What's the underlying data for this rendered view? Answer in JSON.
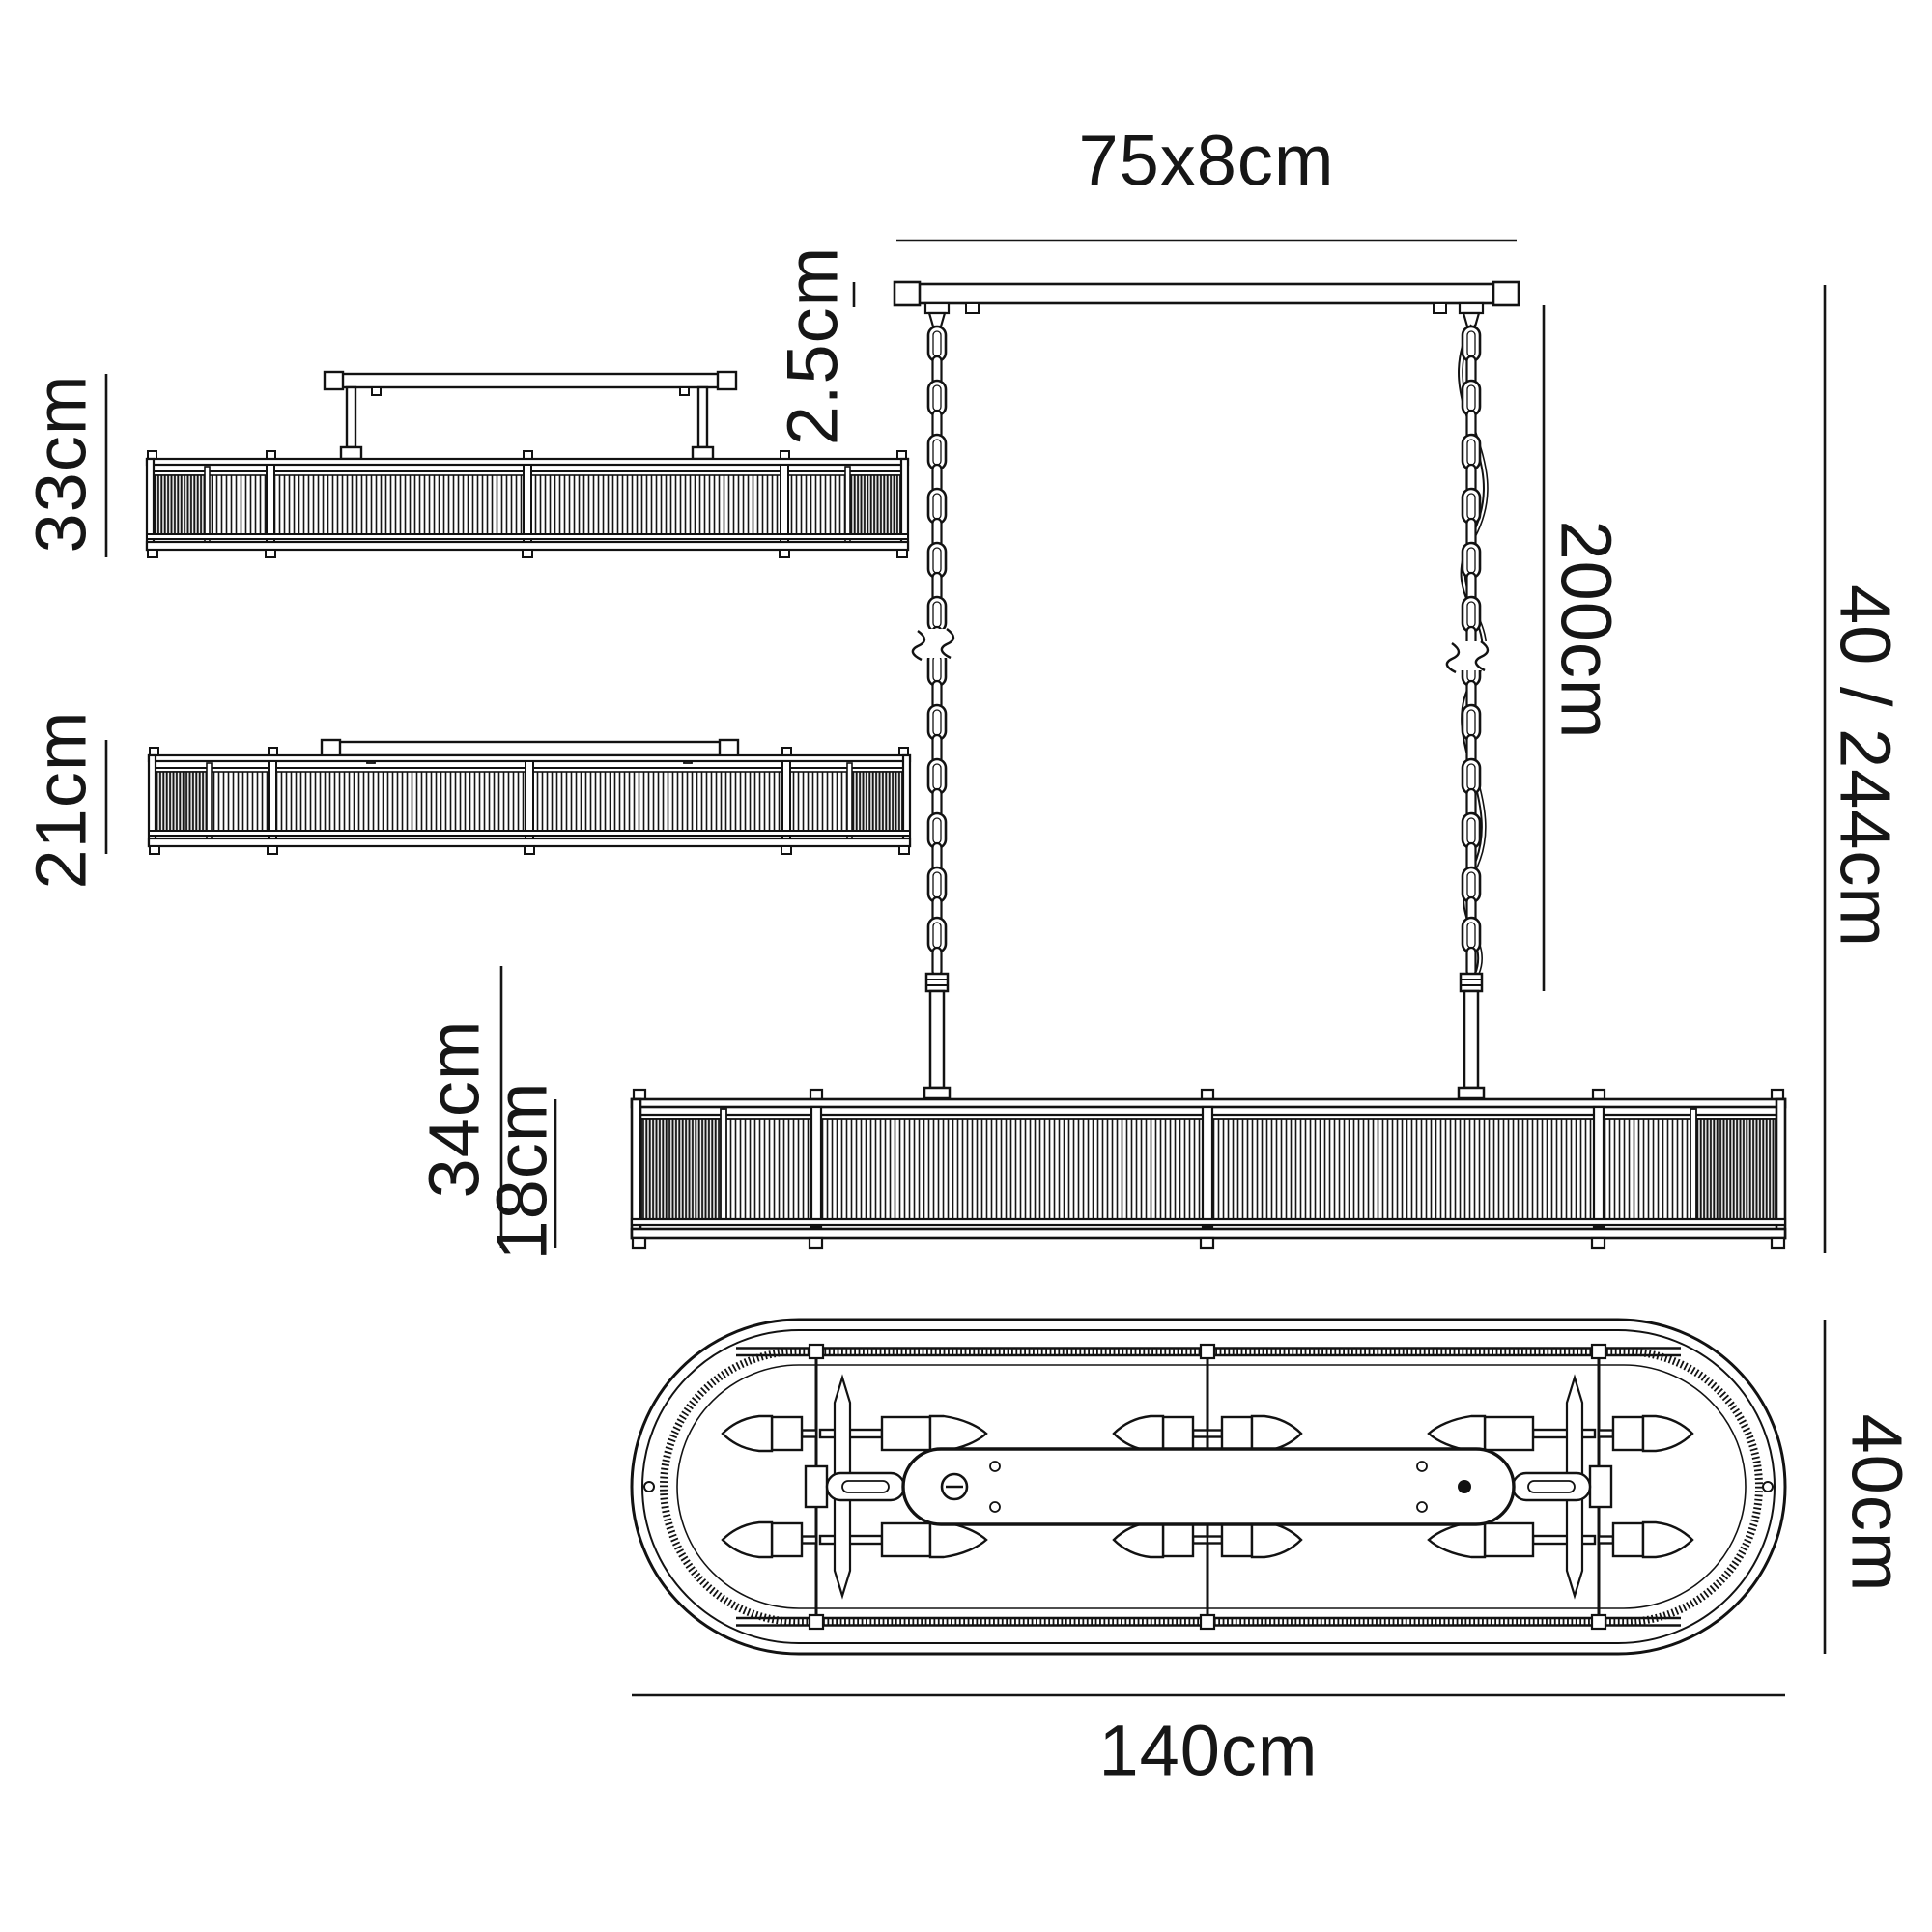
{
  "drawing": {
    "line_color": "#121212",
    "labels": {
      "canopy_size": "75x8cm",
      "canopy_thickness": "2.5cm",
      "chain_length": "200cm",
      "overall_height": "40 / 244cm",
      "semi_flush_height": "33cm",
      "flush_height": "21cm",
      "pendant_drop_min": "34cm",
      "body_height": "18cm",
      "fixture_length": "140cm",
      "fixture_width": "40cm"
    }
  }
}
